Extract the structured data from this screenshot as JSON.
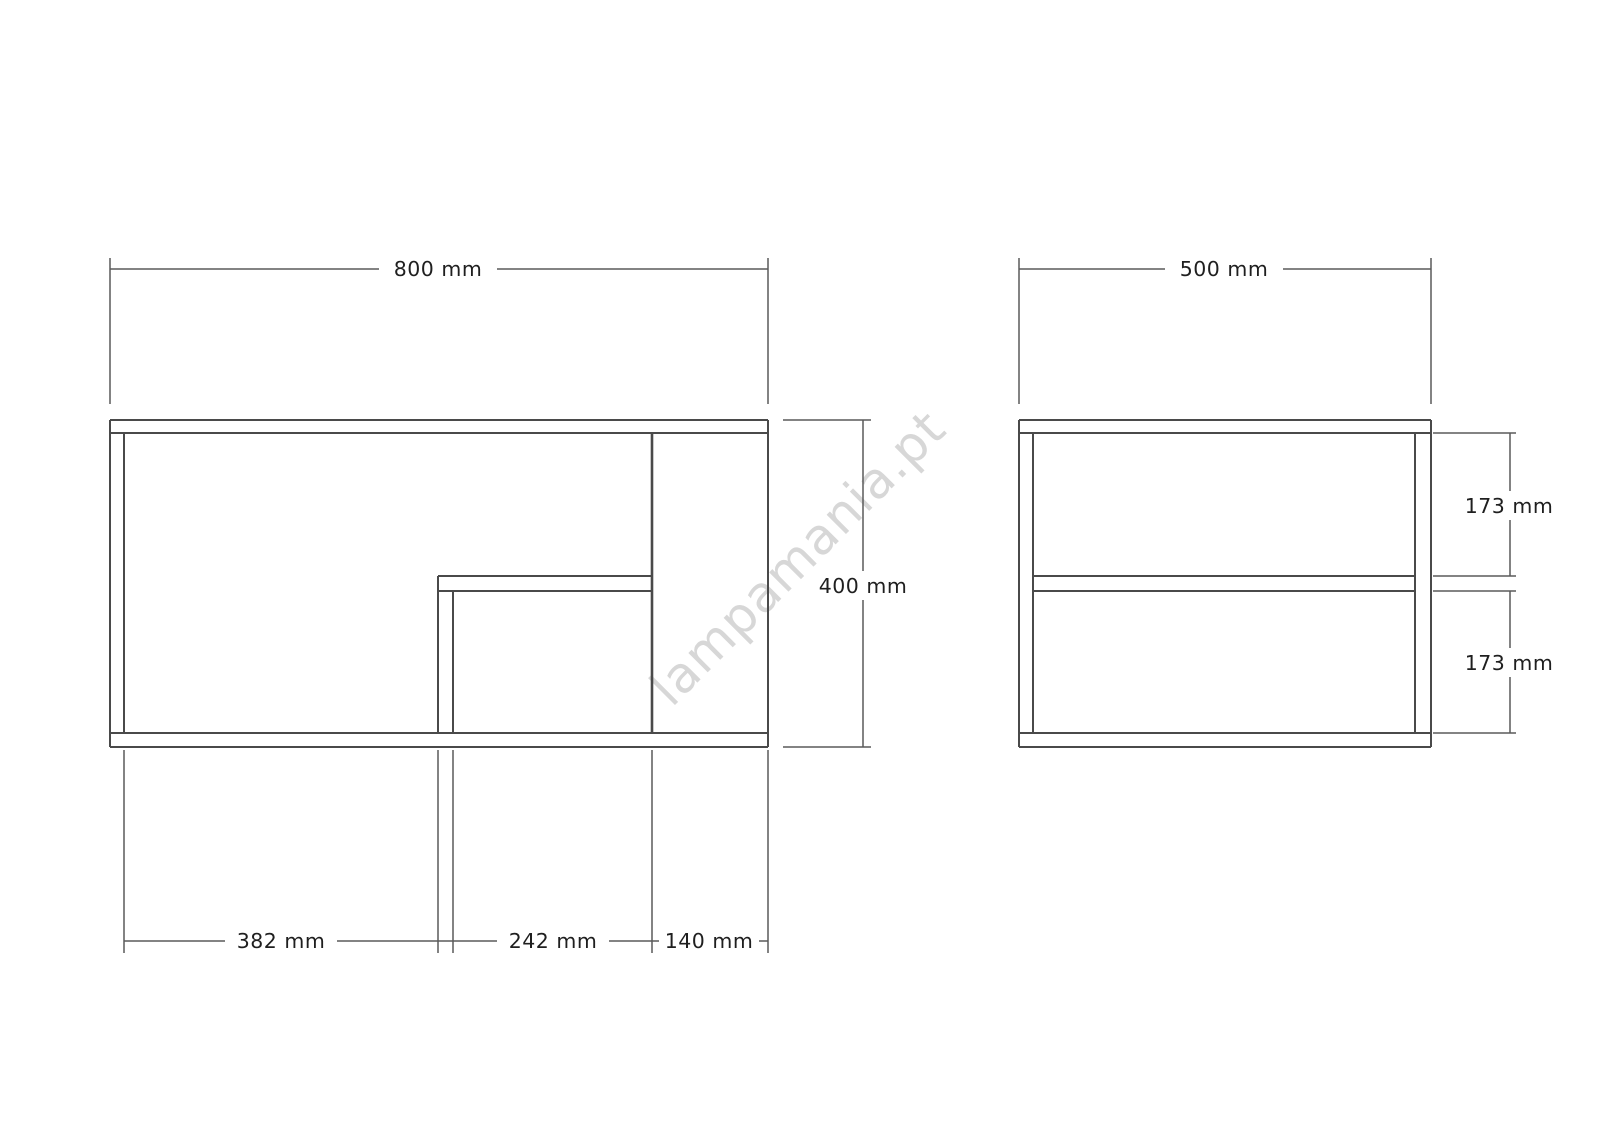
{
  "watermark": {
    "text": "lampamania.pt",
    "color": "#d7d7d7"
  },
  "views": {
    "front": {
      "dims": {
        "width": "800 mm",
        "height": "400 mm",
        "bottom_left": "382 mm",
        "bottom_middle": "242 mm",
        "bottom_right": "140 mm"
      }
    },
    "side": {
      "dims": {
        "width": "500 mm",
        "upper_gap": "173 mm",
        "lower_gap": "173 mm"
      }
    }
  },
  "colors": {
    "outline": "#4a4a4a",
    "dimension_line": "#5a5a5a",
    "label_text": "#1f1f1f",
    "background": "#ffffff"
  }
}
